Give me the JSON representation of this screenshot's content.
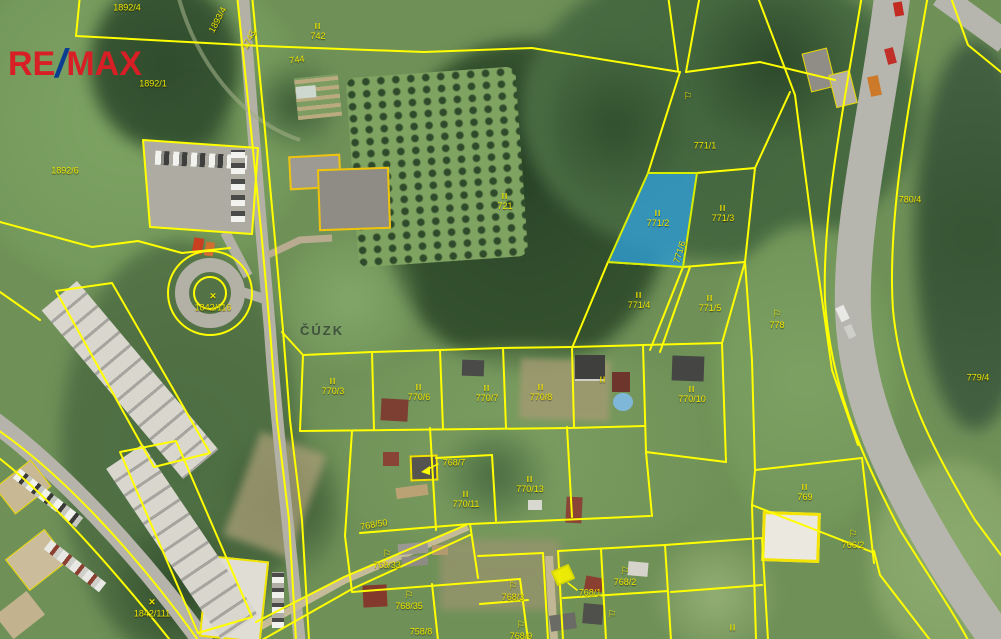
{
  "brand": {
    "part1": "RE",
    "slash": "/",
    "part2": "MAX",
    "red": "#d81f26",
    "blue": "#0b3e91"
  },
  "watermark": {
    "text": "ČÚZK"
  },
  "colors": {
    "parcel_line": "#ffff00",
    "label_text": "#f0e600",
    "highlight_fill": "#2f9fd8"
  },
  "map": {
    "highlighted_parcel": "771/2",
    "labels": [
      {
        "t": "1892/4",
        "x": 127,
        "y": 8
      },
      {
        "t": "1893/4",
        "x": 218,
        "y": 20,
        "r": -62
      },
      {
        "t": "1743",
        "x": 249,
        "y": 40,
        "r": -62
      },
      {
        "t": "742",
        "x": 318,
        "y": 32,
        "s": "II"
      },
      {
        "t": "744",
        "x": 297,
        "y": 60,
        "r": -8
      },
      {
        "t": "1892/1",
        "x": 153,
        "y": 84
      },
      {
        "t": "1892/6",
        "x": 65,
        "y": 171
      },
      {
        "t": "721",
        "x": 505,
        "y": 202,
        "s": "II"
      },
      {
        "t": "771/1",
        "x": 705,
        "y": 146
      },
      {
        "t": "",
        "x": 688,
        "y": 98,
        "s": "flag"
      },
      {
        "t": "771/2",
        "x": 658,
        "y": 219,
        "s": "II"
      },
      {
        "t": "771/3",
        "x": 723,
        "y": 214,
        "s": "II"
      },
      {
        "t": "771/4",
        "x": 639,
        "y": 301,
        "s": "II"
      },
      {
        "t": "771/5",
        "x": 710,
        "y": 304,
        "s": "II"
      },
      {
        "t": "771/6",
        "x": 680,
        "y": 252,
        "r": -73
      },
      {
        "t": "778",
        "x": 777,
        "y": 320,
        "s": "flag"
      },
      {
        "t": "780/4",
        "x": 910,
        "y": 200
      },
      {
        "t": "779/4",
        "x": 978,
        "y": 378
      },
      {
        "t": "1842/116",
        "x": 213,
        "y": 302,
        "s": "tree"
      },
      {
        "t": "1842/111",
        "x": 152,
        "y": 608,
        "s": "tree"
      },
      {
        "t": "770/3",
        "x": 333,
        "y": 387,
        "s": "II"
      },
      {
        "t": "770/6",
        "x": 419,
        "y": 393,
        "s": "II"
      },
      {
        "t": "770/7",
        "x": 487,
        "y": 394,
        "s": "II"
      },
      {
        "t": "770/8",
        "x": 541,
        "y": 393,
        "s": "II"
      },
      {
        "t": "",
        "x": 603,
        "y": 381,
        "s": "II"
      },
      {
        "t": "770/10",
        "x": 692,
        "y": 395,
        "s": "II"
      },
      {
        "t": "770/11",
        "x": 466,
        "y": 500,
        "s": "II"
      },
      {
        "t": "770/13",
        "x": 530,
        "y": 485,
        "s": "II"
      },
      {
        "t": "768/7",
        "x": 454,
        "y": 463
      },
      {
        "t": "768/50",
        "x": 374,
        "y": 525,
        "r": -10
      },
      {
        "t": "768/33",
        "x": 387,
        "y": 560,
        "s": "flag"
      },
      {
        "t": "768/35",
        "x": 409,
        "y": 601,
        "s": "flag"
      },
      {
        "t": "758/8",
        "x": 421,
        "y": 632
      },
      {
        "t": "768/3",
        "x": 513,
        "y": 592,
        "s": "flag"
      },
      {
        "t": "768/1",
        "x": 590,
        "y": 593
      },
      {
        "t": "768/2",
        "x": 625,
        "y": 577,
        "s": "flag"
      },
      {
        "t": "",
        "x": 612,
        "y": 616,
        "s": "flag"
      },
      {
        "t": "768/9",
        "x": 521,
        "y": 631,
        "s": "flag"
      },
      {
        "t": "769",
        "x": 805,
        "y": 493,
        "s": "II"
      },
      {
        "t": "766/2",
        "x": 853,
        "y": 540,
        "s": "flag"
      },
      {
        "t": "",
        "x": 733,
        "y": 629,
        "s": "II"
      }
    ]
  }
}
